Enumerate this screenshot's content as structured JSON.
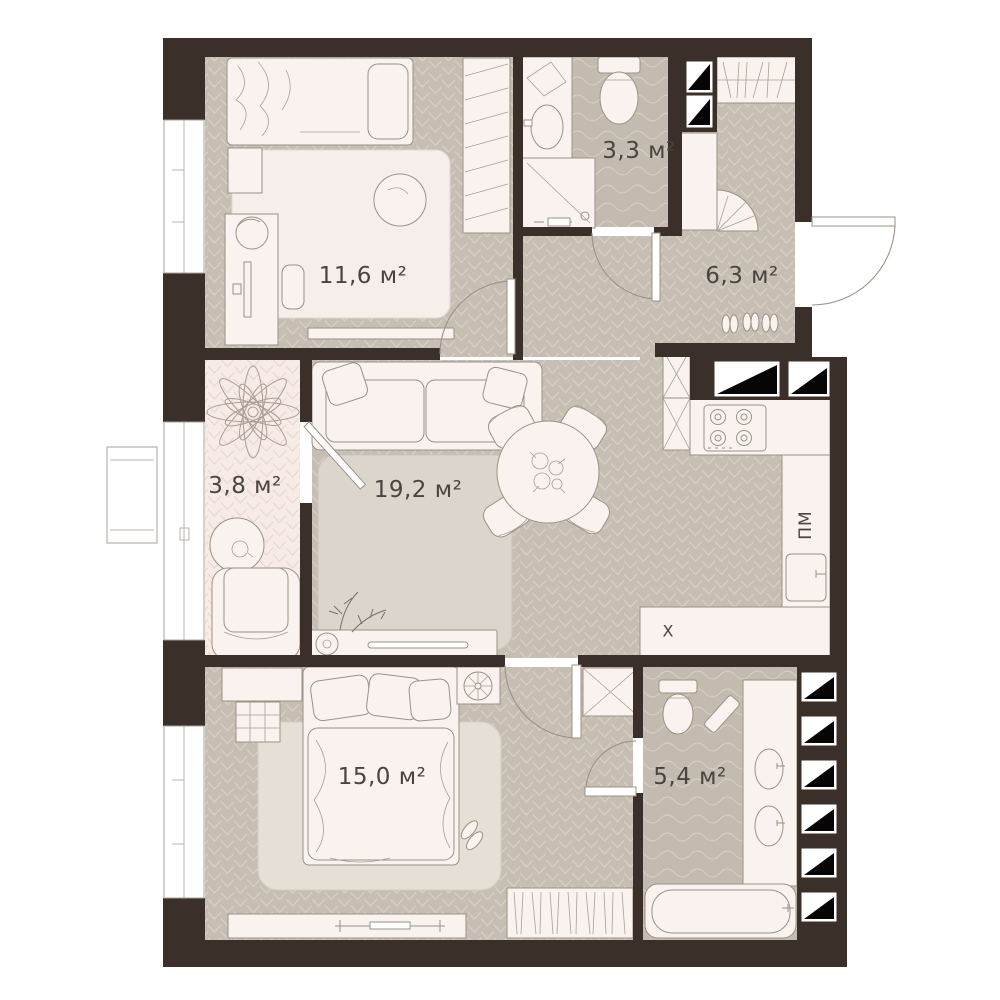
{
  "plan": {
    "name": "Apartment floor plan",
    "rooms": [
      {
        "id": "bedroom-1",
        "area_label": "11,6 м²"
      },
      {
        "id": "bathroom-1",
        "area_label": "3,3 м²"
      },
      {
        "id": "hallway",
        "area_label": "6,3 м²"
      },
      {
        "id": "loggia",
        "area_label": "3,8 м²"
      },
      {
        "id": "living-room",
        "area_label": "19,2 м²"
      },
      {
        "id": "bedroom-2",
        "area_label": "15,0 м²"
      },
      {
        "id": "bathroom-2",
        "area_label": "5,4 м²"
      }
    ],
    "appliances": {
      "dishwasher_label": "ПМ",
      "fridge_label": "Х"
    },
    "colors": {
      "wall": "#3a3029",
      "floor": "#c6beb3",
      "loggia_floor": "#f6ebe7",
      "furniture": "#f9f2ee",
      "label_text": "#4a443f"
    }
  }
}
